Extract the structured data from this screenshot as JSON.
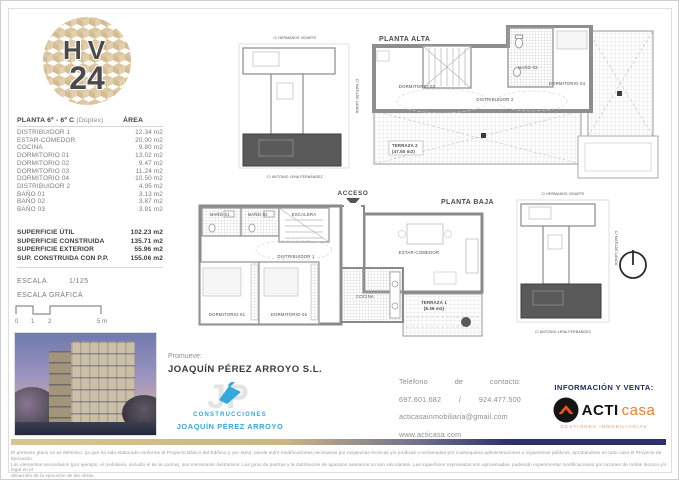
{
  "logo": {
    "top": "HV",
    "bottom": "24"
  },
  "area_table": {
    "title": "PLANTA 6º - 6º C",
    "title_note": "(Dúplex)",
    "area_header": "ÁREA",
    "rows": [
      {
        "label": "DISTRIBUIDOR 1",
        "value": "12.34 m2"
      },
      {
        "label": "ESTAR-COMEDOR",
        "value": "20.00 m2"
      },
      {
        "label": "COCINA",
        "value": "9.80 m2"
      },
      {
        "label": "DORMITORIO 01",
        "value": "13.02 m2"
      },
      {
        "label": "DORMITORIO 02",
        "value": "9.47 m2"
      },
      {
        "label": "DORMITORIO 03",
        "value": "11.24 m2"
      },
      {
        "label": "DORMITORIO 04",
        "value": "10.50 m2"
      },
      {
        "label": "DISTRIBUIDOR 2",
        "value": "4.95 m2"
      },
      {
        "label": "BAÑO 01",
        "value": "3.13 m2"
      },
      {
        "label": "BAÑO 02",
        "value": "3.87 m2"
      },
      {
        "label": "BAÑO 03",
        "value": "3.91 m2"
      }
    ]
  },
  "summary": {
    "rows": [
      {
        "label": "SUPERFICIE ÚTIL",
        "value": "102.23 m2"
      },
      {
        "label": "SUPERFICIE CONSTRUIDA",
        "value": "135.71 m2"
      },
      {
        "label": "SUPERFICIE EXTERIOR",
        "value": "55.96 m2"
      },
      {
        "label": "SUP. CONSTRUIDA CON P.P.",
        "value": "155.06 m2"
      }
    ]
  },
  "scale": {
    "label": "ESCALA",
    "ratio": "1/125",
    "graphic_label": "ESCALA GRÁFICA",
    "tick0": "0",
    "tick1": "1",
    "tick2": "2",
    "tick5": "5 m"
  },
  "keyplan": {
    "street_top": "C/ HERMANOS VISARTE",
    "street_right": "C/ MATILDE LANDA",
    "street_bottom": "C/ ANTONIO LENA FERNÁNDEZ"
  },
  "planta_alta": {
    "title": "PLANTA ALTA",
    "dormitorio03": "DORMITORIO 03",
    "bano03": "BAÑO 03",
    "dormitorio04": "DORMITORIO 04",
    "distribuidor2": "DISTRIBUIDOR 2",
    "terraza2": "TERRAZA 2",
    "terraza2_area": "(47.60 m2)"
  },
  "planta_baja": {
    "title": "PLANTA BAJA",
    "acceso": "ACCESO",
    "bano01": "BAÑO 01",
    "bano02": "BAÑO 02",
    "escalera": "ESCALERA",
    "distribuidor1": "DISTRIBUIDOR 1",
    "estar_comedor": "ESTAR-COMEDOR",
    "dormitorio01": "DORMITORIO 01",
    "dormitorio02": "DORMITORIO 02",
    "cocina": "COCINA",
    "terraza1": "TERRAZA 1",
    "terraza1_area": "(8.36 m2)"
  },
  "promoter": {
    "label": "Promueve:",
    "name": "JOAQUÍN PÉREZ ARROYO S.L.",
    "logo_line1": "CONSTRUCCIONES",
    "logo_line2": "JOAQUÍN PÉREZ ARROYO"
  },
  "contact": {
    "w1": "Teléfono",
    "w2": "de",
    "w3": "contacto:",
    "phone1": "697.601.682",
    "sep": "/",
    "phone2": "924.477.500",
    "email": "acticasainmobiliaria@gmail.com",
    "web": "www.acticasa.com"
  },
  "agency": {
    "header": "INFORMACIÓN Y VENTA:",
    "brand_bold": "ACTI",
    "brand_light": "casa",
    "tagline": "GESTIONES INMOBILIARIAS"
  },
  "colors": {
    "logo_tan": "#dcc7a0",
    "navy": "#2e3168",
    "constructor_blue": "#35a8dc",
    "brand_orange": "#e8551a"
  },
  "disclaimer": {
    "line1": "El presente plano no es definitivo, ya que ha sido elaborado conforme al Proyecto Básico del Edificio y, por tanto, puede sufrir modificaciones necesarias por exigencias técnicas y/o jurídicas o reclamadas por cualesquiera administraciones u organismos públicos, aprobándose en todo caso el Proyecto de Ejecución.",
    "line2": "Los elementos secundarios (por ejemplo, el mobiliario, incluido el de la cocina), son meramente ilustrativos. Los giros de puertas y la distribución de aparatos sanitarios no son vinculantes. Las superficies expresadas son aproximadas, pudiendo experimentar modificaciones por razones de índole técnica y/o legal en el",
    "line3": "desarrollo de la ejecución de las obras."
  }
}
